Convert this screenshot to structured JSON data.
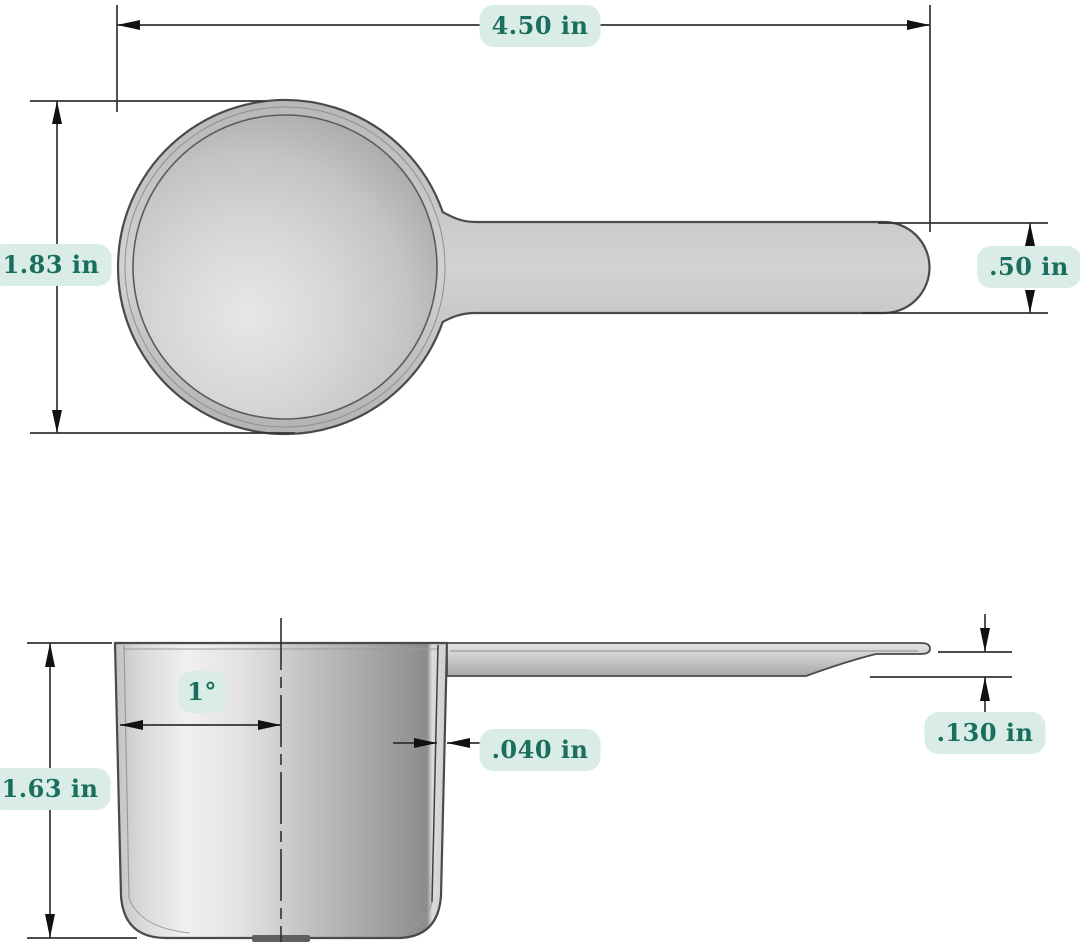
{
  "diagram": {
    "type": "technical-drawing",
    "subject": "plastic measuring scoop, dimensioned top view and side section view",
    "units": "in",
    "colors": {
      "background": "#ffffff",
      "label_background": "#d9ece6",
      "label_text": "#1a6e5e",
      "dimension_line": "#333333",
      "body_outline": "#4a4a4a",
      "body_fill": "#c6c6c6"
    },
    "views": {
      "top": {
        "dims": {
          "overall_length": "4.50 in",
          "bowl_diameter": "1.83 in",
          "handle_width": ".50 in"
        }
      },
      "side": {
        "dims": {
          "draft_angle": "1°",
          "wall_thickness": ".040 in",
          "cup_depth": "1.63 in",
          "handle_thickness": ".130 in"
        }
      }
    }
  }
}
